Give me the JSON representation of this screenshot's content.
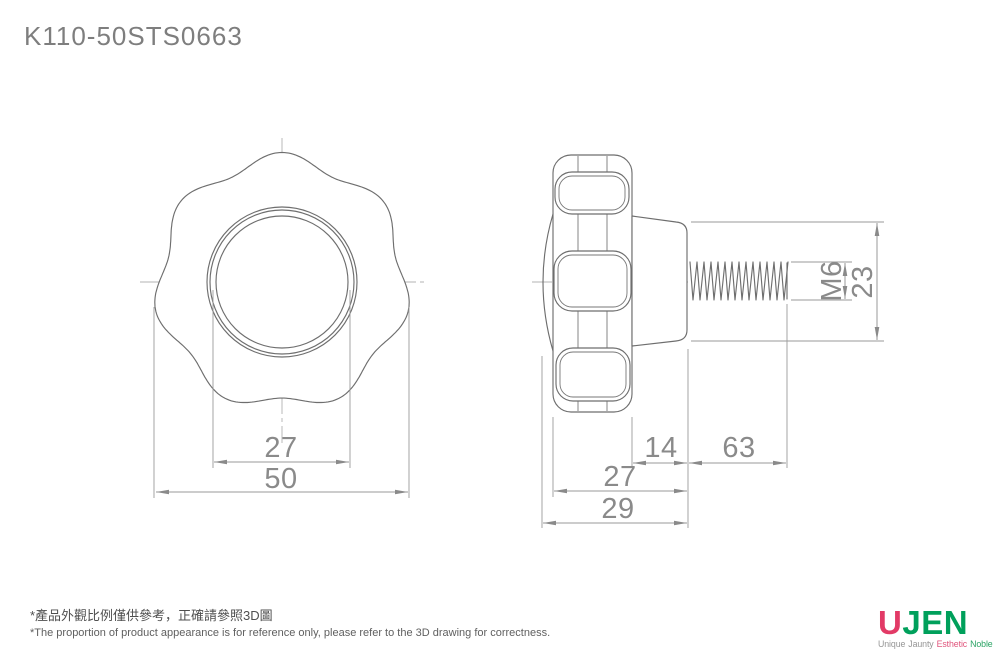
{
  "title": "K110-50STS0663",
  "front_view": {
    "dim_knob_inner_circle": "27",
    "dim_knob_outer_diameter": "50"
  },
  "side_view": {
    "dim_hub_protrusion": "14",
    "dim_thread_length": "63",
    "dim_body_depth": "27",
    "dim_overall_depth": "29",
    "dim_thread_spec": "M6",
    "dim_hub_diameter": "23"
  },
  "notes": {
    "line1_zh": "*產品外觀比例僅供參考，正確請參照3D圖",
    "line2_en": "*The proportion of product appearance is for reference only, please refer to the 3D drawing for correctness."
  },
  "logo": {
    "brand_first_letter": "U",
    "brand_rest": "JEN",
    "tagline_word1": "Unique",
    "tagline_word2": "Jaunty",
    "tagline_word3": "Esthetic",
    "tagline_word4": "Noble",
    "color_u": "#e23a66",
    "color_jen": "#00a05b",
    "color_tagline_gray": "#969696",
    "color_tagline_pink": "#e0557c",
    "color_tagline_green": "#2ba465"
  },
  "drawing_colors": {
    "outline": "#6e6e6e",
    "dimension": "#9a9a9a",
    "dim_text": "#8a8a8a",
    "centerline": "#b3b3b3"
  }
}
